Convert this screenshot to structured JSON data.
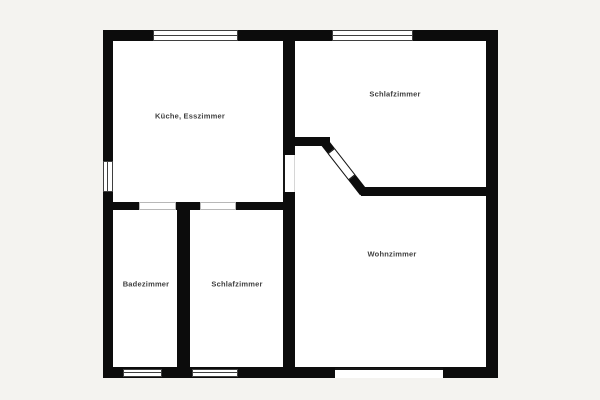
{
  "colors": {
    "background_color": "#f4f3f0",
    "wall_color": "#0c0c0c",
    "room_color": "#ffffff",
    "label_color": "#404040"
  },
  "plan": {
    "type": "floor-plan",
    "rooms": [
      {
        "id": "kueche-esszimmer",
        "label": "Küche, Esszimmer"
      },
      {
        "id": "schlafzimmer-top",
        "label": "Schlafzimmer"
      },
      {
        "id": "badezimmer",
        "label": "Badezimmer"
      },
      {
        "id": "schlafzimmer-bottom",
        "label": "Schlafzimmer"
      },
      {
        "id": "wohnzimmer",
        "label": "Wohnzimmer"
      }
    ]
  }
}
